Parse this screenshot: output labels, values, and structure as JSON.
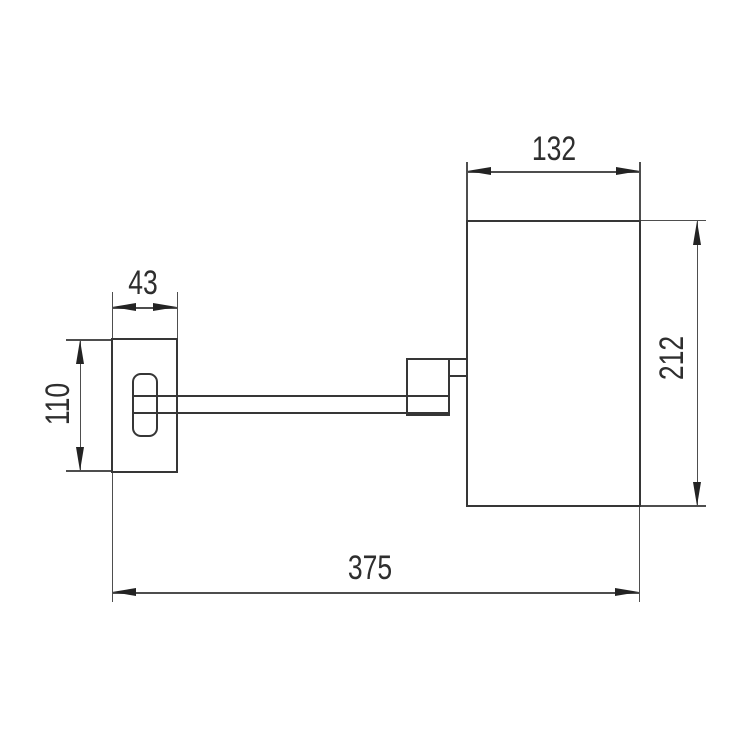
{
  "page": {
    "background": "#ffffff"
  },
  "drawing": {
    "kind": "technical-dimension-drawing",
    "subject": "wall-mounted mirror with swing arm, side elevation with wall plate",
    "units_shown": "none (plain numbers, mm implied)",
    "colors": {
      "outline": "#363636",
      "dimension_lines": "#4e4e4e",
      "arrowheads": "#232323",
      "text": "#2e2e2e"
    },
    "dimensions": {
      "body_width": "132",
      "body_height": "212",
      "wall_plate_width": "43",
      "wall_plate_height": "110",
      "overall_projection": "375"
    }
  }
}
